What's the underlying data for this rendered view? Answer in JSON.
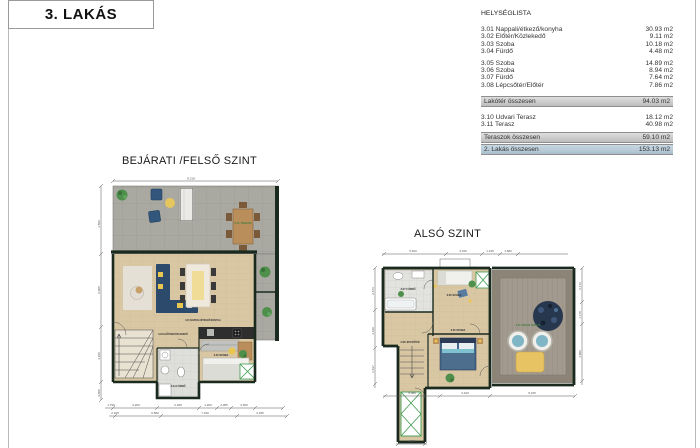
{
  "page": {
    "title": "3. LAKÁS"
  },
  "room_list": {
    "heading": "HELYSÉGLISTA",
    "rows1": [
      {
        "label": "3.01 Nappali/étkező/konyha",
        "area": "30.93 m2"
      },
      {
        "label": "3.02 Előtér/Közlekedő",
        "area": "9.11 m2"
      },
      {
        "label": "3.03 Szoba",
        "area": "10.18 m2"
      },
      {
        "label": "3.04 Fürdő",
        "area": "4.48 m2"
      }
    ],
    "rows2": [
      {
        "label": "3.05 Szoba",
        "area": "14.89 m2"
      },
      {
        "label": "3.06 Szoba",
        "area": "8.94 m2"
      },
      {
        "label": "3.07 Fürdő",
        "area": "7.64 m2"
      },
      {
        "label": "3.08 Lépcsőtér/Előtér",
        "area": "7.86 m2"
      }
    ],
    "living_total": {
      "label": "Lakótér összesen",
      "area": "94.03 m2"
    },
    "terrace_rows": [
      {
        "label": "3.10 Udvari Terasz",
        "area": "18.12 m2"
      },
      {
        "label": "3.11 Terasz",
        "area": "40.98 m2"
      }
    ],
    "terrace_total": {
      "label": "Teraszok összesen",
      "area": "59.10 m2"
    },
    "grand_total": {
      "label": "2. Lakás összesen",
      "area": "153.13 m2"
    }
  },
  "plans": {
    "upper": {
      "title": "BEJÁRATI /FELSŐ SZINT",
      "labels": {
        "terrace": "3.11 TERASZ",
        "living": "3.01 NAPPALI/ÉTKEZŐ/KONYHA",
        "hall": "3.02 ELŐTÉR/KÖZLEKEDŐ",
        "room": "3.03 SZOBA",
        "bath": "3.04 FÜRDŐ"
      },
      "dims": {
        "top": "8.218",
        "left": [
          "1.500",
          "0.905",
          "4.250",
          "4.005"
        ],
        "bottom1": [
          "1.790",
          "3.200",
          "2.180",
          "1.260",
          "2.385",
          "3.300"
        ],
        "bottom2": [
          "2.405",
          "6.580",
          "7.230",
          "3.185"
        ]
      }
    },
    "lower": {
      "title": "ALSÓ SZINT",
      "labels": {
        "bath": "3.07 FÜRDŐ",
        "room6": "3.06 SZOBA",
        "room5": "3.05 SZOBA",
        "stairs": "3.08 LÉPCSŐTÉR",
        "terrace": "3.10 UDVARI TERASZ"
      },
      "dims": {
        "top": [
          "5.400",
          "3.150",
          "1.445",
          "1.580"
        ],
        "right": [
          "2.172",
          "1.170",
          "3.880"
        ],
        "bottom": [
          "5.080",
          "3.420",
          "5.435"
        ],
        "column": "1.480",
        "left": [
          "2.673",
          "3.190",
          "2.537"
        ]
      }
    }
  },
  "colors": {
    "wall": "#1a2a1f",
    "floor": "#d9c7a4",
    "terrace_tile": "#a9a9a2",
    "deck": "#a29a8f",
    "sofa": "#2c4a6b",
    "bed": "#4e87a8",
    "accent_yellow": "#e9c64f",
    "plant_green": "#4e8f4c",
    "shaft_green": "#3f9a4f",
    "bar_gray": "#c9c9c9",
    "bar_blue": "#b7c9d6"
  }
}
